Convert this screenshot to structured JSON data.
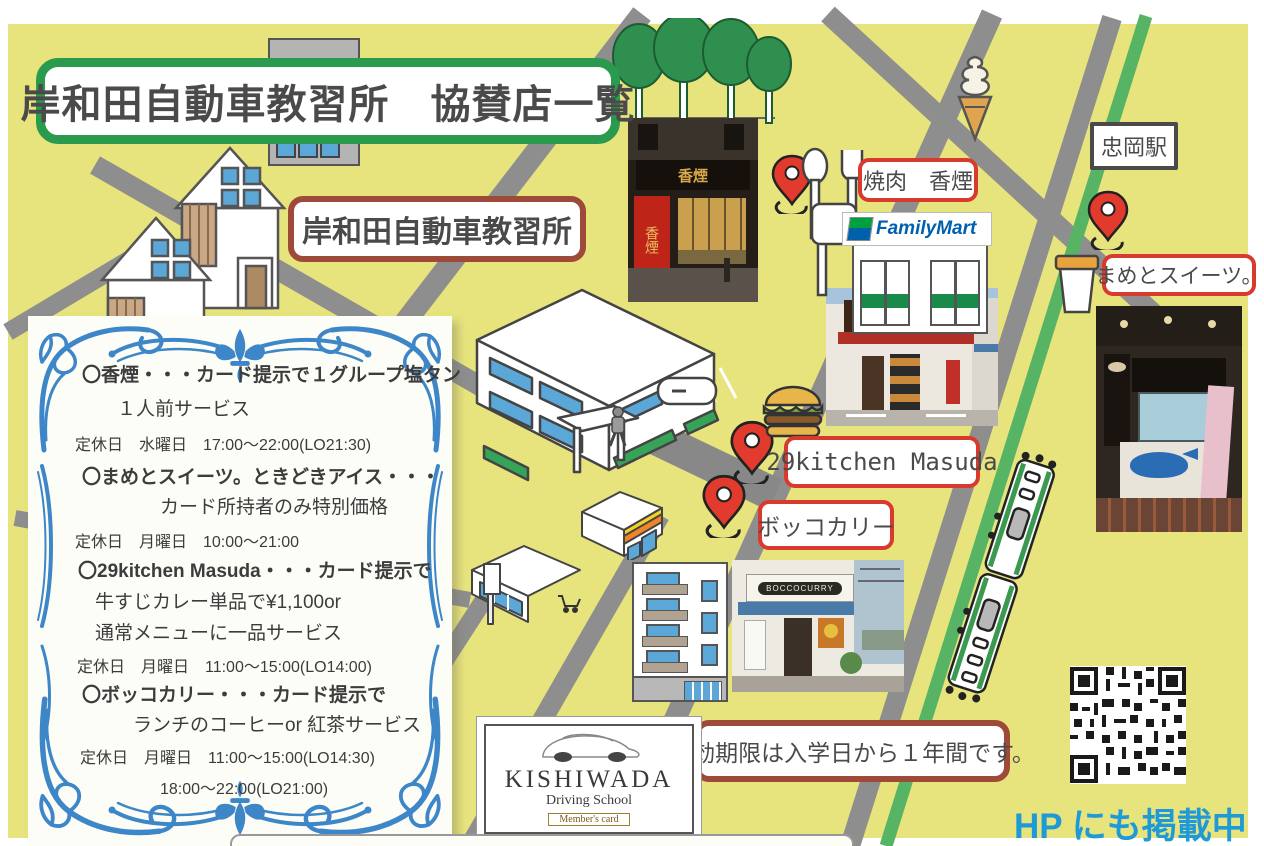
{
  "title": "岸和田自動車教習所　協賛店一覧",
  "map_labels": {
    "school": "岸和田自動車教習所",
    "station": "忠岡駅",
    "yakiniku": "焼肉　香煙",
    "sweets": "まめとスイーツ。",
    "kitchen": "29kitchen Masuda",
    "bokko": "ボッコカリー"
  },
  "notes": {
    "validity": "有効期限は入学日から１年間です。",
    "hp": "HP にも掲載中"
  },
  "familymart": "FamilyMart",
  "photos": {
    "kaen_sign": "香煙",
    "kaen_banner": "香煙",
    "masuda_sign": "Masuda",
    "bocco_sign": "BOCCOCURRY"
  },
  "card": {
    "name": "KISHIWADA",
    "subtitle": "Driving School",
    "badge": "Member's card"
  },
  "panel": {
    "lines": [
      {
        "text": "〇香煙・・・カード提示で１グループ塩タン",
        "style": "head"
      },
      {
        "text": "１人前サービス",
        "style": "cont"
      },
      {
        "text": "定休日　水曜日　17:00～22:00(LO21:30)",
        "style": "note"
      },
      {
        "text": "〇まめとスイーツ。ときどきアイス・・・",
        "style": "head"
      },
      {
        "text": "カード所持者のみ特別価格",
        "style": "cont"
      },
      {
        "text": "定休日　月曜日　10:00～21:00",
        "style": "note"
      },
      {
        "text": "〇29kitchen Masuda・・・カード提示で",
        "style": "head"
      },
      {
        "text": "牛すじカレー単品で¥1,100or",
        "style": "cont"
      },
      {
        "text": "通常メニューに一品サービス",
        "style": "cont"
      },
      {
        "text": "定休日　月曜日　11:00～15:00(LO14:00)",
        "style": "note"
      },
      {
        "text": "〇ボッコカリー・・・カード提示で",
        "style": "head"
      },
      {
        "text": "ランチのコーヒーor 紅茶サービス",
        "style": "cont"
      },
      {
        "text": "定休日　月曜日　11:00～15:00(LO14:30)",
        "style": "note"
      },
      {
        "text": "18:00～22:00(LO21:00)",
        "style": "note"
      }
    ]
  },
  "colors": {
    "map_bg": "#e7e37d",
    "road_gray": "#8e8e8e",
    "rail_green": "#56b464",
    "title_green": "#2a9b4e",
    "label_red": "#d93a2e",
    "label_brown": "#9e4a38",
    "pin_red": "#e23b2e",
    "ornament_blue": "#3d86c8",
    "hp_blue": "#1f9ad8",
    "familymart_blue": "#0060b0",
    "familymart_green": "#00a040"
  }
}
